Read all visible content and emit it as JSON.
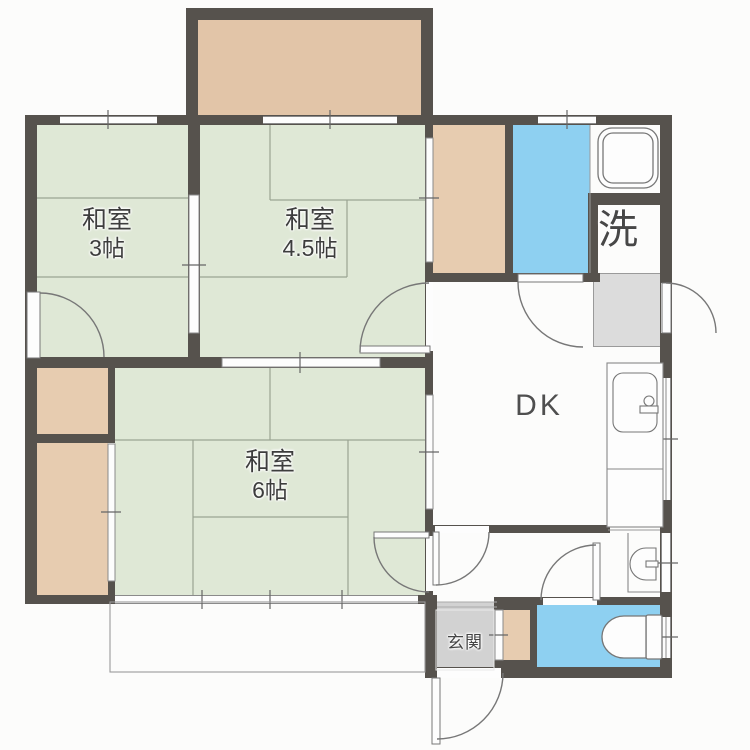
{
  "floorplan": {
    "rooms": [
      {
        "label": "和室",
        "size": "3帖"
      },
      {
        "label": "和室",
        "size": "4.5帖"
      },
      {
        "label": "和室",
        "size": "6帖"
      },
      {
        "label": "DK",
        "size": ""
      },
      {
        "label": "洗",
        "size": ""
      },
      {
        "label": "玄関",
        "size": ""
      }
    ],
    "fixtures": {
      "bathtub": "bathtub-icon",
      "kitchen_sink": "kitchen-sink-icon",
      "washbasin": "washbasin-icon",
      "toilet": "toilet-icon",
      "washing_machine_space": "washing-machine-space",
      "veranda": "veranda-outline"
    },
    "colors": {
      "wall": "#56524d",
      "tatami": "#dfe8d6",
      "balcony": "#e2c5a8",
      "closet": "#e7ccb0",
      "bath": "#8ed0f1",
      "genkan": "#d2d2d2",
      "washer": "#dcdcdc",
      "line": "#8a8a8a",
      "arc": "#777777",
      "text": "#3d3d3d",
      "bg": "#fcfcfb"
    }
  }
}
